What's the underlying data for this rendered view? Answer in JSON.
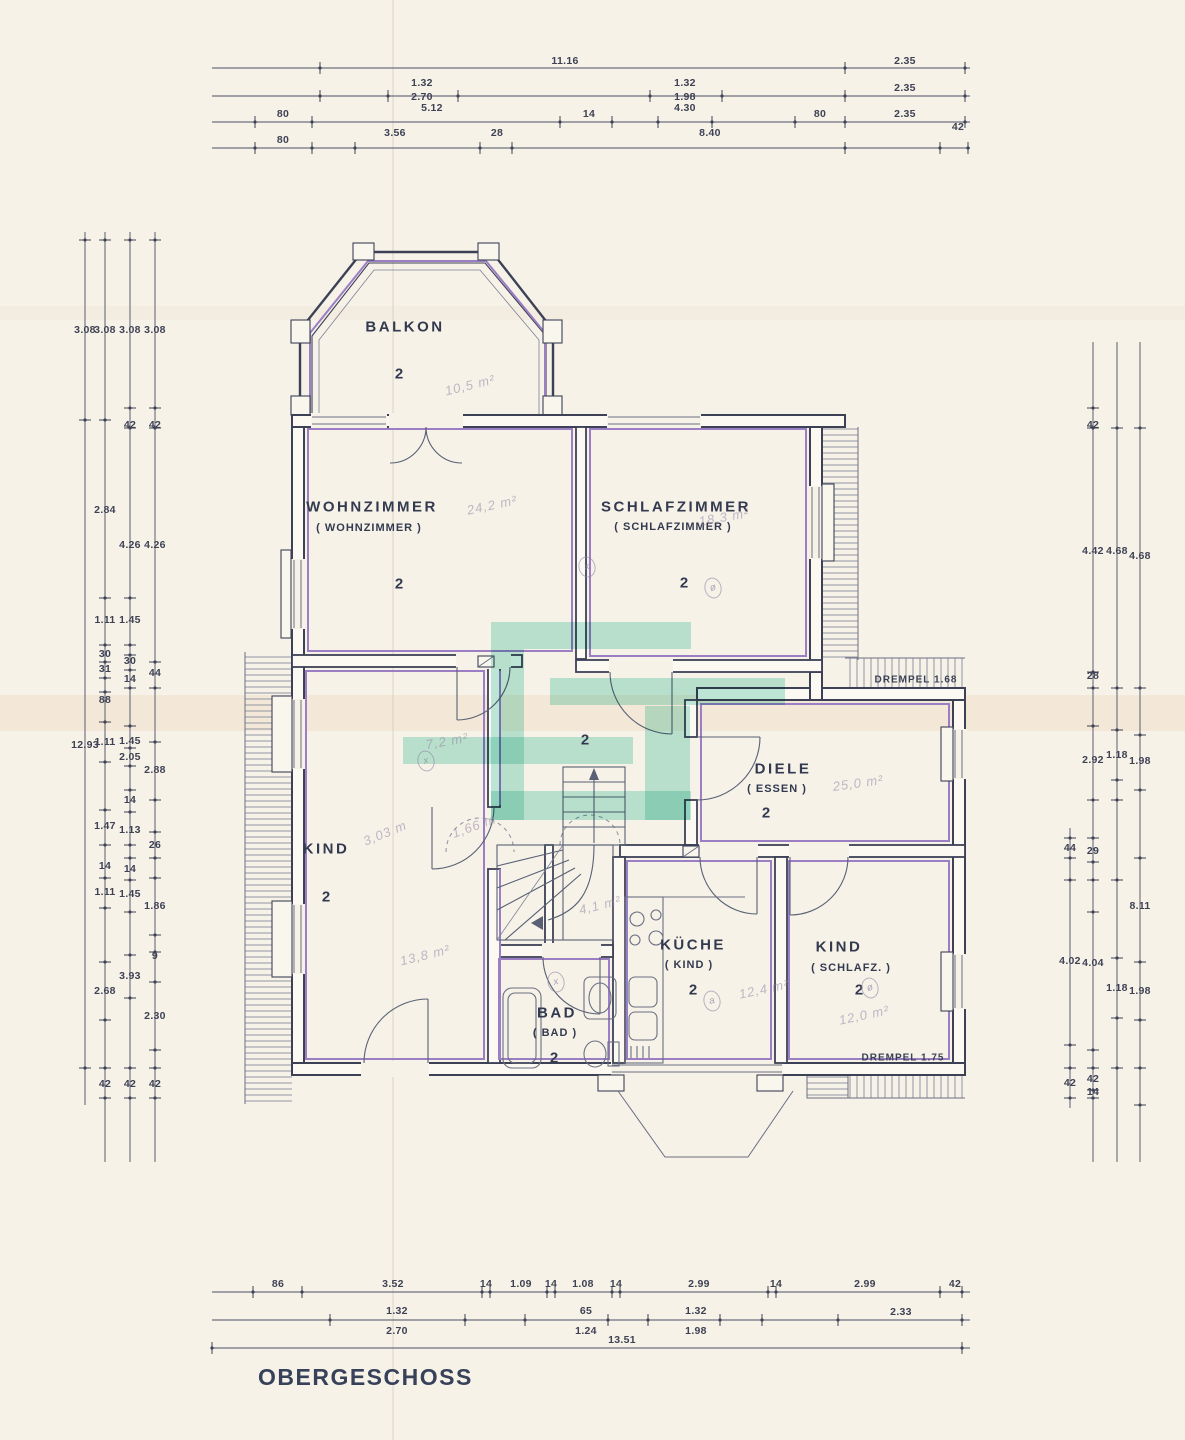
{
  "floor_label": "OBERGESCHOSS",
  "colors": {
    "paper": "#f6f2e8",
    "wall_ink": "#3d4156",
    "accent_purple": "#9b7ec4",
    "watermark_teal": "#7fd8c3",
    "pencil": "#9084a4",
    "text": "#333a50"
  },
  "rooms": [
    {
      "id": "balkon",
      "name": "BALKON",
      "sub": "",
      "num": "2",
      "nx": 405,
      "ny": 327,
      "sx": 0,
      "sy": 0,
      "ux": 399,
      "uy": 374
    },
    {
      "id": "wohnzimmer",
      "name": "WOHNZIMMER",
      "sub": "( WOHNZIMMER )",
      "num": "2",
      "nx": 372,
      "ny": 507,
      "sx": 369,
      "sy": 528,
      "ux": 399,
      "uy": 584
    },
    {
      "id": "schlafzimmer",
      "name": "SCHLAFZIMMER",
      "sub": "( SCHLAFZIMMER )",
      "num": "2",
      "nx": 676,
      "ny": 507,
      "sx": 673,
      "sy": 527,
      "ux": 684,
      "uy": 583
    },
    {
      "id": "flur",
      "name": "",
      "sub": "",
      "num": "2",
      "nx": 0,
      "ny": 0,
      "sx": 0,
      "sy": 0,
      "ux": 585,
      "uy": 740
    },
    {
      "id": "kind",
      "name": "KIND",
      "sub": "",
      "num": "2",
      "nx": 326,
      "ny": 849,
      "sx": 0,
      "sy": 0,
      "ux": 326,
      "uy": 897
    },
    {
      "id": "diele",
      "name": "DIELE",
      "sub": "( ESSEN )",
      "num": "2",
      "nx": 783,
      "ny": 769,
      "sx": 777,
      "sy": 789,
      "ux": 766,
      "uy": 813
    },
    {
      "id": "kueche",
      "name": "KÜCHE",
      "sub": "( KIND )",
      "num": "2",
      "nx": 693,
      "ny": 945,
      "sx": 689,
      "sy": 965,
      "ux": 693,
      "uy": 990
    },
    {
      "id": "bad",
      "name": "BAD",
      "sub": "( BAD )",
      "num": "2",
      "nx": 557,
      "ny": 1013,
      "sx": 555,
      "sy": 1033,
      "ux": 554,
      "uy": 1058
    },
    {
      "id": "kind-schlafz",
      "name": "KIND",
      "sub": "( SCHLAFZ. )",
      "num": "2",
      "nx": 839,
      "ny": 947,
      "sx": 851,
      "sy": 968,
      "ux": 859,
      "uy": 990
    }
  ],
  "drempel_notes": [
    {
      "text": "DREMPEL  1.68",
      "x": 916,
      "y": 680
    },
    {
      "text": "DREMPEL  1.75",
      "x": 903,
      "y": 1058
    }
  ],
  "dimensions": {
    "top": [
      {
        "t": "11.16",
        "x": 565,
        "y": 61
      },
      {
        "t": "2.35",
        "x": 905,
        "y": 61
      },
      {
        "t": "1.32",
        "x": 422,
        "y": 83
      },
      {
        "t": "2.70",
        "x": 422,
        "y": 97
      },
      {
        "t": "1.32",
        "x": 685,
        "y": 83
      },
      {
        "t": "1.98",
        "x": 685,
        "y": 97
      },
      {
        "t": "2.35",
        "x": 905,
        "y": 88
      },
      {
        "t": "80",
        "x": 283,
        "y": 114
      },
      {
        "t": "5.12",
        "x": 432,
        "y": 108
      },
      {
        "t": "14",
        "x": 589,
        "y": 114
      },
      {
        "t": "4.30",
        "x": 685,
        "y": 108
      },
      {
        "t": "80",
        "x": 820,
        "y": 114
      },
      {
        "t": "2.35",
        "x": 905,
        "y": 114
      },
      {
        "t": "80",
        "x": 283,
        "y": 140
      },
      {
        "t": "3.56",
        "x": 395,
        "y": 133
      },
      {
        "t": "28",
        "x": 497,
        "y": 133
      },
      {
        "t": "8.40",
        "x": 710,
        "y": 133
      },
      {
        "t": "42",
        "x": 958,
        "y": 127
      }
    ],
    "bottom": [
      {
        "t": "86",
        "x": 278,
        "y": 1284
      },
      {
        "t": "3.52",
        "x": 393,
        "y": 1284
      },
      {
        "t": "14",
        "x": 486,
        "y": 1284
      },
      {
        "t": "1.09",
        "x": 521,
        "y": 1284
      },
      {
        "t": "14",
        "x": 551,
        "y": 1284
      },
      {
        "t": "1.08",
        "x": 583,
        "y": 1284
      },
      {
        "t": "14",
        "x": 616,
        "y": 1284
      },
      {
        "t": "2.99",
        "x": 699,
        "y": 1284
      },
      {
        "t": "14",
        "x": 776,
        "y": 1284
      },
      {
        "t": "2.99",
        "x": 865,
        "y": 1284
      },
      {
        "t": "42",
        "x": 955,
        "y": 1284
      },
      {
        "t": "1.32",
        "x": 397,
        "y": 1311
      },
      {
        "t": "2.70",
        "x": 397,
        "y": 1331
      },
      {
        "t": "65",
        "x": 586,
        "y": 1311
      },
      {
        "t": "1.24",
        "x": 586,
        "y": 1331
      },
      {
        "t": "1.32",
        "x": 696,
        "y": 1311
      },
      {
        "t": "1.98",
        "x": 696,
        "y": 1331
      },
      {
        "t": "2.33",
        "x": 901,
        "y": 1312
      },
      {
        "t": "13.51",
        "x": 622,
        "y": 1340
      }
    ],
    "left": [
      {
        "t": "3.08",
        "x": 85,
        "y": 330
      },
      {
        "t": "3.08",
        "x": 105,
        "y": 330
      },
      {
        "t": "3.08",
        "x": 130,
        "y": 330
      },
      {
        "t": "3.08",
        "x": 155,
        "y": 330
      },
      {
        "t": "42",
        "x": 130,
        "y": 425
      },
      {
        "t": "42",
        "x": 155,
        "y": 425
      },
      {
        "t": "2.84",
        "x": 105,
        "y": 510
      },
      {
        "t": "4.26",
        "x": 130,
        "y": 545
      },
      {
        "t": "4.26",
        "x": 155,
        "y": 545
      },
      {
        "t": "1.11",
        "x": 105,
        "y": 620
      },
      {
        "t": "1.45",
        "x": 130,
        "y": 620
      },
      {
        "t": "30",
        "x": 105,
        "y": 654
      },
      {
        "t": "31",
        "x": 105,
        "y": 669
      },
      {
        "t": "30",
        "x": 130,
        "y": 661
      },
      {
        "t": "14",
        "x": 130,
        "y": 679
      },
      {
        "t": "44",
        "x": 155,
        "y": 673
      },
      {
        "t": "88",
        "x": 105,
        "y": 700
      },
      {
        "t": "12.93",
        "x": 85,
        "y": 745
      },
      {
        "t": "1.11",
        "x": 105,
        "y": 742
      },
      {
        "t": "1.45",
        "x": 130,
        "y": 741
      },
      {
        "t": "2.05",
        "x": 130,
        "y": 757
      },
      {
        "t": "2.88",
        "x": 155,
        "y": 770
      },
      {
        "t": "14",
        "x": 130,
        "y": 800
      },
      {
        "t": "1.47",
        "x": 105,
        "y": 826
      },
      {
        "t": "1.13",
        "x": 130,
        "y": 830
      },
      {
        "t": "26",
        "x": 155,
        "y": 845
      },
      {
        "t": "14",
        "x": 105,
        "y": 866
      },
      {
        "t": "14",
        "x": 130,
        "y": 869
      },
      {
        "t": "1.11",
        "x": 105,
        "y": 892
      },
      {
        "t": "1.45",
        "x": 130,
        "y": 894
      },
      {
        "t": "1.86",
        "x": 155,
        "y": 906
      },
      {
        "t": "9",
        "x": 155,
        "y": 956
      },
      {
        "t": "3.93",
        "x": 130,
        "y": 976
      },
      {
        "t": "2.68",
        "x": 105,
        "y": 991
      },
      {
        "t": "2.30",
        "x": 155,
        "y": 1016
      },
      {
        "t": "42",
        "x": 105,
        "y": 1084
      },
      {
        "t": "42",
        "x": 130,
        "y": 1084
      },
      {
        "t": "42",
        "x": 155,
        "y": 1084
      }
    ],
    "right": [
      {
        "t": "42",
        "x": 1093,
        "y": 425
      },
      {
        "t": "4.42",
        "x": 1093,
        "y": 551
      },
      {
        "t": "4.68",
        "x": 1117,
        "y": 551
      },
      {
        "t": "4.68",
        "x": 1140,
        "y": 556
      },
      {
        "t": "28",
        "x": 1093,
        "y": 676
      },
      {
        "t": "2.92",
        "x": 1093,
        "y": 760
      },
      {
        "t": "1.18",
        "x": 1117,
        "y": 755
      },
      {
        "t": "1.98",
        "x": 1140,
        "y": 761
      },
      {
        "t": "44",
        "x": 1070,
        "y": 848
      },
      {
        "t": "29",
        "x": 1093,
        "y": 851
      },
      {
        "t": "8.11",
        "x": 1140,
        "y": 906
      },
      {
        "t": "4.02",
        "x": 1070,
        "y": 961
      },
      {
        "t": "4.04",
        "x": 1093,
        "y": 963
      },
      {
        "t": "1.18",
        "x": 1117,
        "y": 988
      },
      {
        "t": "1.98",
        "x": 1140,
        "y": 991
      },
      {
        "t": "42",
        "x": 1070,
        "y": 1083
      },
      {
        "t": "42",
        "x": 1093,
        "y": 1079
      },
      {
        "t": "14",
        "x": 1093,
        "y": 1092
      }
    ]
  },
  "pencil_annotations": [
    {
      "t": "10,5 m²",
      "x": 470,
      "y": 385,
      "r": -14
    },
    {
      "t": "24,2 m²",
      "x": 492,
      "y": 505,
      "r": -12
    },
    {
      "t": "18,3 m²",
      "x": 724,
      "y": 517,
      "r": -10
    },
    {
      "t": "7,2 m²",
      "x": 447,
      "y": 741,
      "r": -10
    },
    {
      "t": "25,0 m²",
      "x": 858,
      "y": 783,
      "r": -8
    },
    {
      "t": "3,03 m",
      "x": 385,
      "y": 833,
      "r": -22
    },
    {
      "t": "1,66 m",
      "x": 474,
      "y": 826,
      "r": -20
    },
    {
      "t": "13,8 m²",
      "x": 425,
      "y": 955,
      "r": -14
    },
    {
      "t": "4,1 m²",
      "x": 600,
      "y": 905,
      "r": -14
    },
    {
      "t": "12,4 m²",
      "x": 764,
      "y": 989,
      "r": -12
    },
    {
      "t": "12,0 m²",
      "x": 864,
      "y": 1015,
      "r": -12
    }
  ],
  "circled_marks": [
    {
      "t": "x",
      "x": 587,
      "y": 567
    },
    {
      "t": "ø",
      "x": 713,
      "y": 588
    },
    {
      "t": "x",
      "x": 426,
      "y": 761
    },
    {
      "t": "x",
      "x": 556,
      "y": 982
    },
    {
      "t": "ø",
      "x": 870,
      "y": 988
    },
    {
      "t": "a",
      "x": 712,
      "y": 1001
    }
  ]
}
